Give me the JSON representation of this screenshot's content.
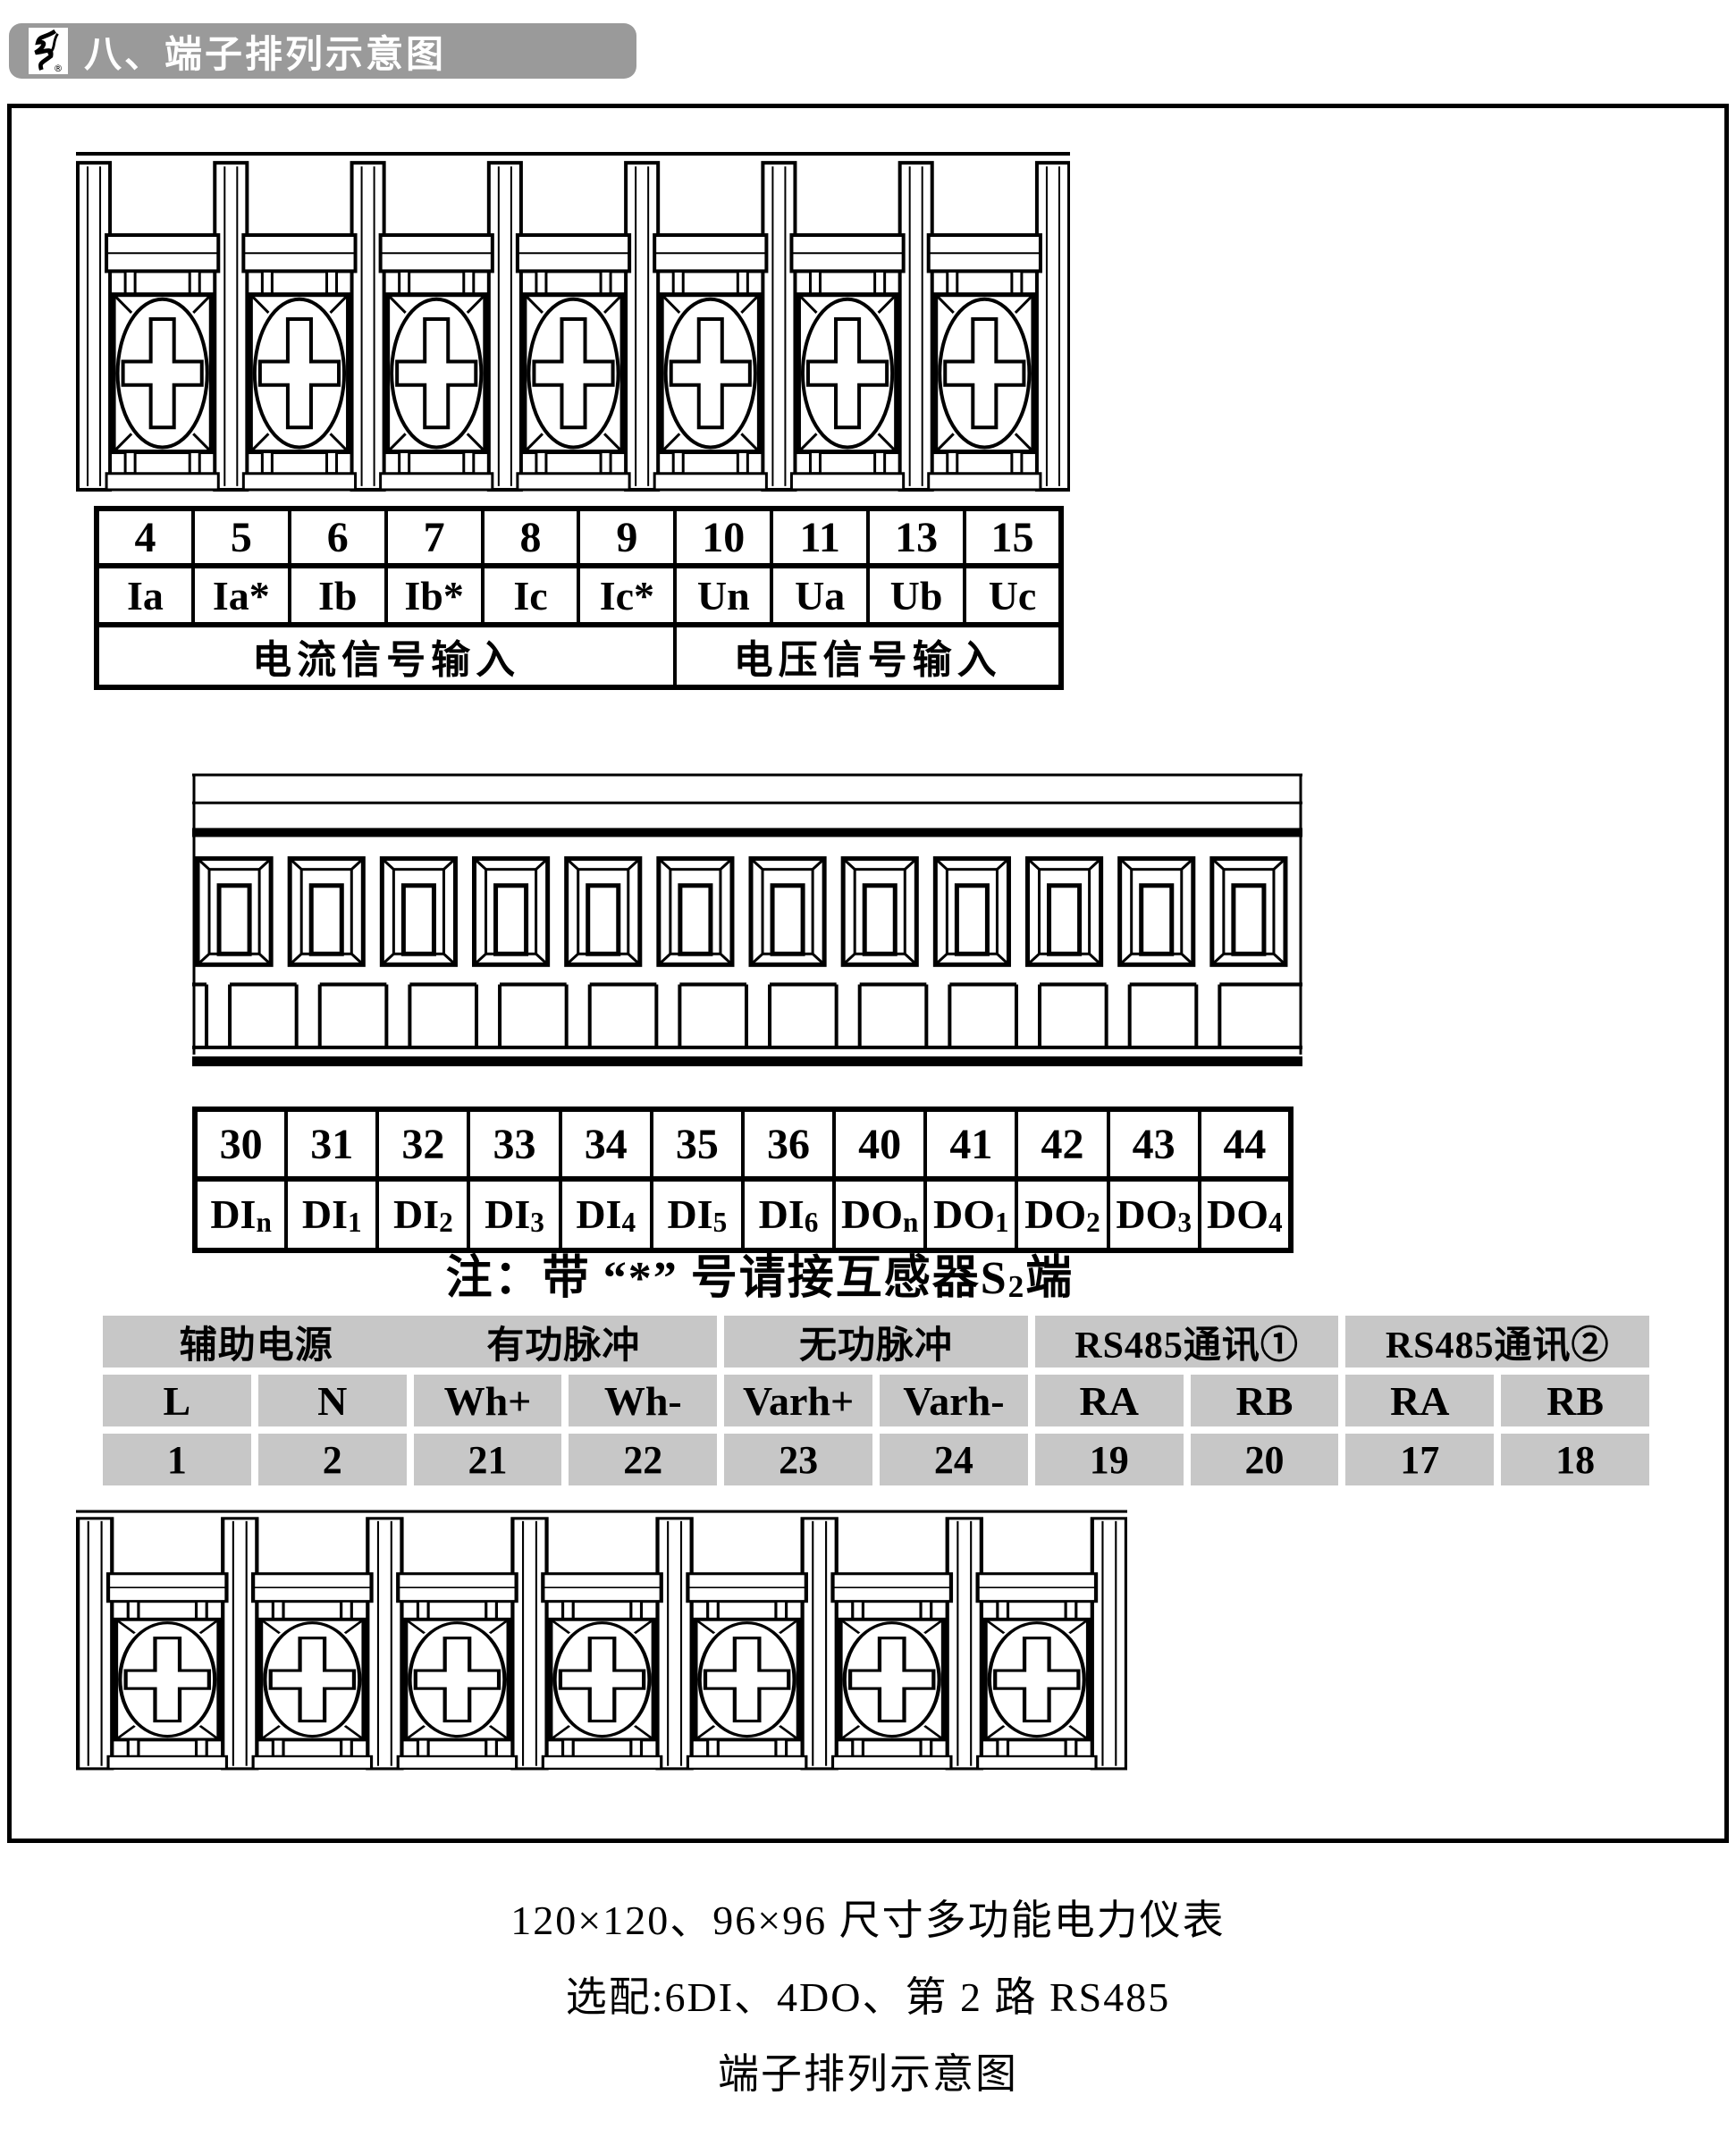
{
  "header": {
    "title": "八、端子排列示意图",
    "logo_mark": "®"
  },
  "colors": {
    "header_bar": "#9a9a9a",
    "cell_gray": "#c7c7c7",
    "line": "#000000"
  },
  "table1": {
    "cols": [
      {
        "no": "4",
        "label": "Ia"
      },
      {
        "no": "5",
        "label": "Ia*"
      },
      {
        "no": "6",
        "label": "Ib"
      },
      {
        "no": "7",
        "label": "Ib*"
      },
      {
        "no": "8",
        "label": "Ic"
      },
      {
        "no": "9",
        "label": "Ic*"
      },
      {
        "no": "10",
        "label": "Un"
      },
      {
        "no": "11",
        "label": "Ua"
      },
      {
        "no": "13",
        "label": "Ub"
      },
      {
        "no": "15",
        "label": "Uc"
      }
    ],
    "groups": [
      {
        "label": "电流信号输入",
        "span": 6
      },
      {
        "label": "电压信号输入",
        "span": 4
      }
    ]
  },
  "table2": {
    "cols": [
      {
        "no": "30",
        "main": "DI",
        "sub": "n"
      },
      {
        "no": "31",
        "main": "DI",
        "sub": "1"
      },
      {
        "no": "32",
        "main": "DI",
        "sub": "2"
      },
      {
        "no": "33",
        "main": "DI",
        "sub": "3"
      },
      {
        "no": "34",
        "main": "DI",
        "sub": "4"
      },
      {
        "no": "35",
        "main": "DI",
        "sub": "5"
      },
      {
        "no": "36",
        "main": "DI",
        "sub": "6"
      },
      {
        "no": "40",
        "main": "DO",
        "sub": "n"
      },
      {
        "no": "41",
        "main": "DO",
        "sub": "1"
      },
      {
        "no": "42",
        "main": "DO",
        "sub": "2"
      },
      {
        "no": "43",
        "main": "DO",
        "sub": "3"
      },
      {
        "no": "44",
        "main": "DO",
        "sub": "4"
      }
    ]
  },
  "note": {
    "part1": "注：带",
    "star": "“*”",
    "part2": "号请接互感器S",
    "sub": "2",
    "part3": "端"
  },
  "gray_table": {
    "headers": [
      "辅助电源",
      "有功脉冲",
      "无功脉冲",
      "RS485通讯①",
      "RS485通讯②"
    ],
    "signals": [
      "L",
      "N",
      "Wh+",
      "Wh-",
      "Varh+",
      "Varh-",
      "RA",
      "RB",
      "RA",
      "RB"
    ],
    "numbers": [
      "1",
      "2",
      "21",
      "22",
      "23",
      "24",
      "19",
      "20",
      "17",
      "18"
    ]
  },
  "captions": {
    "line1": "120×120、96×96 尺寸多功能电力仪表",
    "line2": "选配:6DI、4DO、第 2 路 RS485",
    "line3": "端子排列示意图"
  }
}
